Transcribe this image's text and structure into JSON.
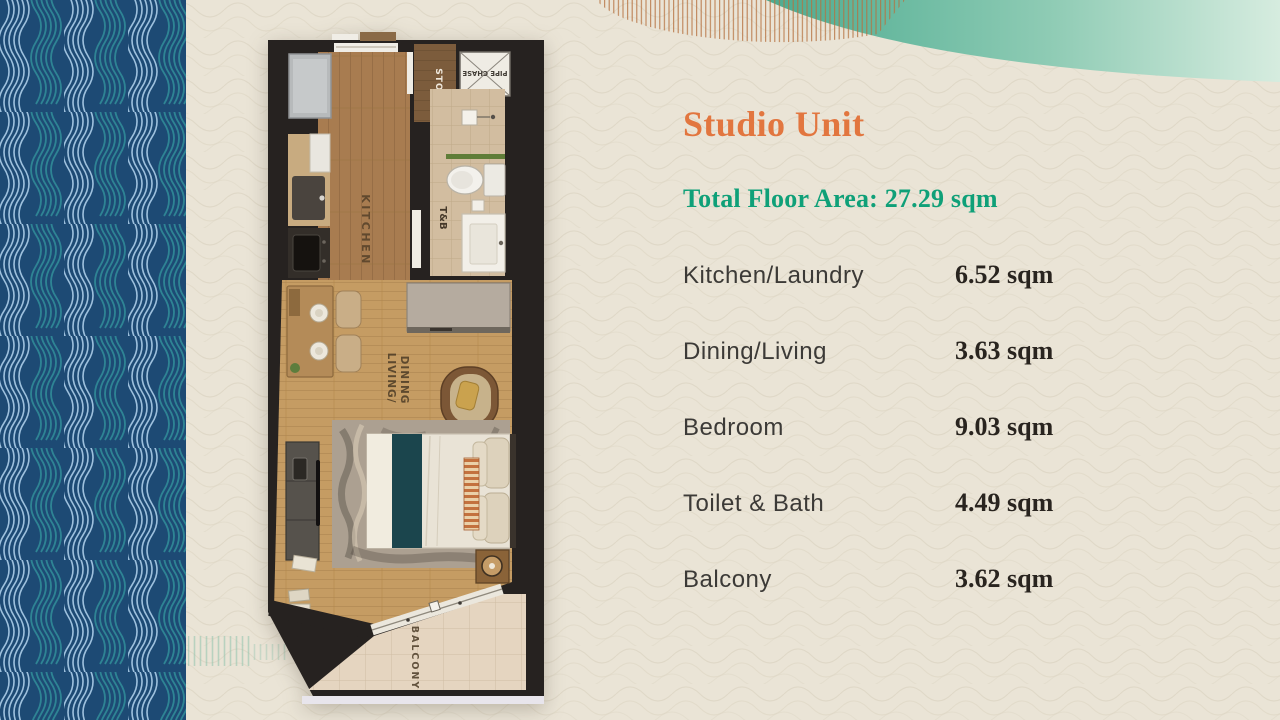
{
  "slide": {
    "background_color": "#eae4d6",
    "texture": "woven-wave-pattern"
  },
  "decor": {
    "left_band_navy": "#1d4a74",
    "left_band_teal": "#2e8494",
    "left_band_light_blue": "#9dc0dd",
    "top_wave_teal": "#57b49a",
    "hatch_orange": "#b5713f",
    "hatch_teal": "#8fc3ad"
  },
  "title": {
    "text": "Studio Unit",
    "color": "#e2763f"
  },
  "total_floor_area": {
    "text": "Total Floor Area: 27.29 sqm",
    "color": "#0fa078"
  },
  "area_table": {
    "rows": [
      {
        "label": "Kitchen/Laundry",
        "value": "6.52 sqm"
      },
      {
        "label": "Dining/Living",
        "value": "3.63 sqm"
      },
      {
        "label": "Bedroom",
        "value": "9.03 sqm"
      },
      {
        "label": "Toilet & Bath",
        "value": "4.49 sqm"
      },
      {
        "label": "Balcony",
        "value": "3.62 sqm"
      }
    ]
  },
  "floorplan": {
    "labels": {
      "kitchen": "KITCHEN",
      "storage": "STO.",
      "pipe_chase": "PIPE CHASE",
      "toilet_bath": "T&B",
      "living_line1": "LIVING/",
      "living_line2": "DINING",
      "balcony": "BALCONY"
    }
  }
}
